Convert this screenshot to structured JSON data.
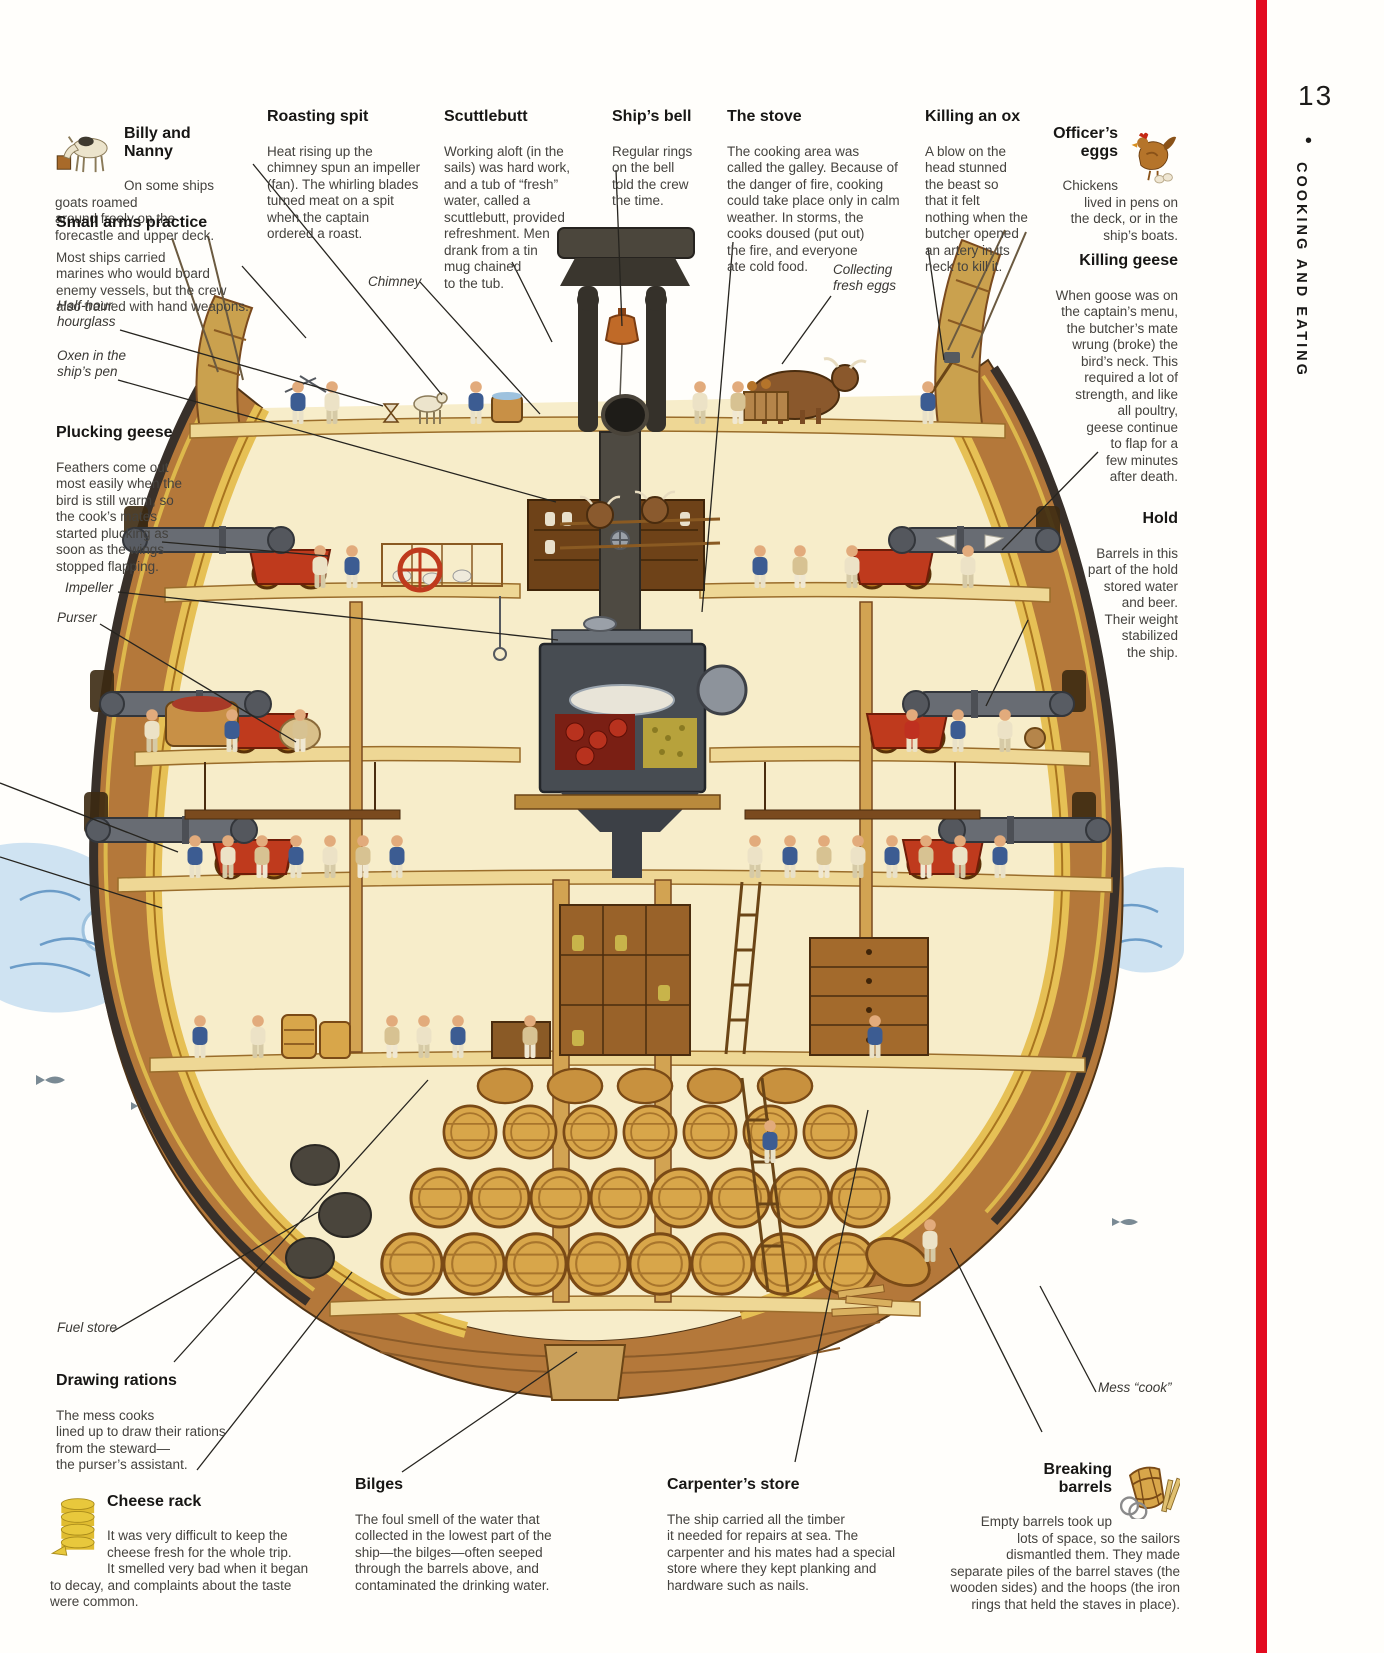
{
  "page": {
    "number": "13",
    "bullet": "•",
    "section_title": "COOKING AND EATING",
    "accent_color": "#e30b20"
  },
  "annotations": {
    "billy_and_nanny": {
      "title": "Billy and Nanny",
      "body": "On some ships\ngoats roamed\naround freely on the\nforecastle and upper deck."
    },
    "small_arms": {
      "title": "Small arms practice",
      "body": "Most ships carried\nmarines who would board\nenemy vessels, but the crew\nalso trained with hand weapons."
    },
    "roasting_spit": {
      "title": "Roasting spit",
      "body": "Heat rising up the\nchimney spun an impeller\n(fan). The whirling blades\nturned meat on a spit\nwhen the captain\nordered a roast."
    },
    "scuttlebutt": {
      "title": "Scuttlebutt",
      "body": "Working aloft (in the\nsails) was hard work,\nand a tub of “fresh”\nwater, called a\nscuttlebutt, provided\nrefreshment. Men\ndrank from a tin\nmug chained\nto the tub."
    },
    "ships_bell": {
      "title": "Ship’s bell",
      "body": "Regular rings\non the bell\ntold the crew\nthe time."
    },
    "the_stove": {
      "title": "The stove",
      "body": "The cooking area was\ncalled the galley. Because of\nthe danger of fire, cooking\ncould take place only in calm\nweather. In storms, the\ncooks doused (put out)\nthe fire, and everyone\nate cold food."
    },
    "killing_an_ox": {
      "title": "Killing an ox",
      "body": "A blow on the\nhead stunned\nthe beast so\nthat it felt\nnothing when the\nbutcher opened\nan artery in its\nneck to kill it."
    },
    "officers_eggs": {
      "title": "Officer’s\neggs",
      "body": "Chickens\nlived in pens on\nthe deck, or in the\nship’s boats."
    },
    "killing_geese": {
      "title": "Killing geese",
      "body": "When goose was on\nthe captain’s menu,\nthe butcher’s mate\nwrung (broke) the\nbird’s neck. This\nrequired a lot of\nstrength, and like\nall poultry,\ngeese continue\nto flap for a\nfew minutes\nafter death."
    },
    "hold": {
      "title": "Hold",
      "body": "Barrels in this\npart of the hold\nstored water\nand beer.\nTheir weight\nstabilized\nthe ship."
    },
    "plucking_geese": {
      "title": "Plucking geese",
      "body": "Feathers come out\nmost easily when the\nbird is still warm, so\nthe cook’s mates\nstarted plucking as\nsoon as the wings\nstopped flapping."
    },
    "drawing_rations": {
      "title": "Drawing rations",
      "body": "The mess cooks\nlined up to draw their rations\nfrom the steward—\nthe purser’s assistant."
    },
    "cheese_rack": {
      "title": "Cheese rack",
      "body": "It was very difficult to keep the\ncheese fresh for the whole trip.\nIt smelled very bad when it began\nto decay, and complaints about the taste\nwere common."
    },
    "bilges": {
      "title": "Bilges",
      "body": "The foul smell of the water that\ncollected in the lowest part of the\nship—the bilges—often seeped\nthrough the barrels above, and\ncontaminated the drinking water."
    },
    "carpenters_store": {
      "title": "Carpenter’s store",
      "body": "The ship carried all the timber\nit needed for repairs at sea. The\ncarpenter and his mates had a special\nstore where they kept planking and\nhardware such as nails."
    },
    "breaking_barrels": {
      "title": "Breaking\nbarrels",
      "body": "Empty barrels took up\nlots of space, so the sailors\ndismantled them. They made\nseparate piles of the barrel staves (the\nwooden sides) and the hoops (the iron\nrings that held the staves in place)."
    }
  },
  "labels": {
    "chimney": "Chimney",
    "half_hour_hourglass": "Half-hour\nhourglass",
    "oxen_pen": "Oxen in the\nship’s pen",
    "impeller": "Impeller",
    "purser": "Purser",
    "collecting_eggs": "Collecting\nfresh eggs",
    "fuel_store": "Fuel store",
    "mess_cook": "Mess “cook”"
  }
}
